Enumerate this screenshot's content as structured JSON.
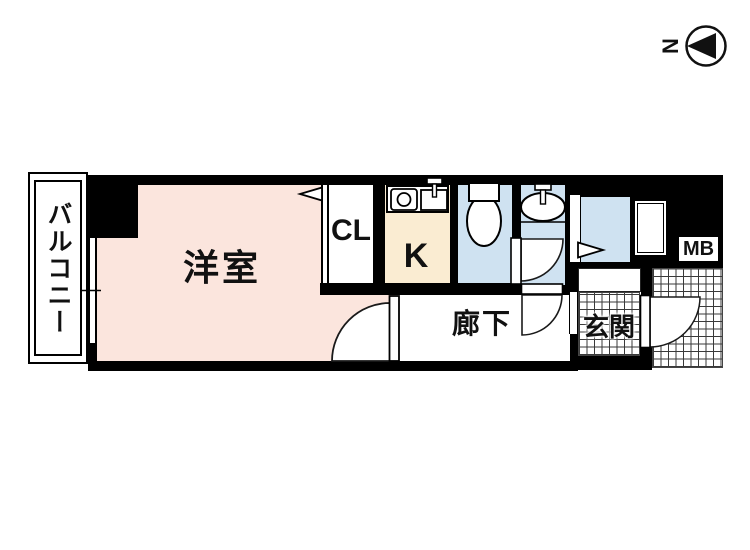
{
  "title": "apartment-floor-plan",
  "compass": {
    "north_label": "N"
  },
  "rooms": {
    "balcony": {
      "label": "バルコニー"
    },
    "western_room": {
      "label": "洋室",
      "fill": "#fbe5dd"
    },
    "closet": {
      "label": "CL",
      "fill": "#ffffff"
    },
    "kitchen": {
      "label": "K",
      "fill": "#faecd2"
    },
    "toilet": {
      "fill": "#cfe2f1"
    },
    "washroom": {
      "fill": "#cfe2f1"
    },
    "bathroom": {
      "fill": "#cfe2f1"
    },
    "corridor": {
      "label": "廊下"
    },
    "entrance": {
      "label": "玄関"
    },
    "meter_box": {
      "label": "MB"
    }
  },
  "colors": {
    "wall": "#000000",
    "tile_grid_line": "#3a3a3a"
  }
}
